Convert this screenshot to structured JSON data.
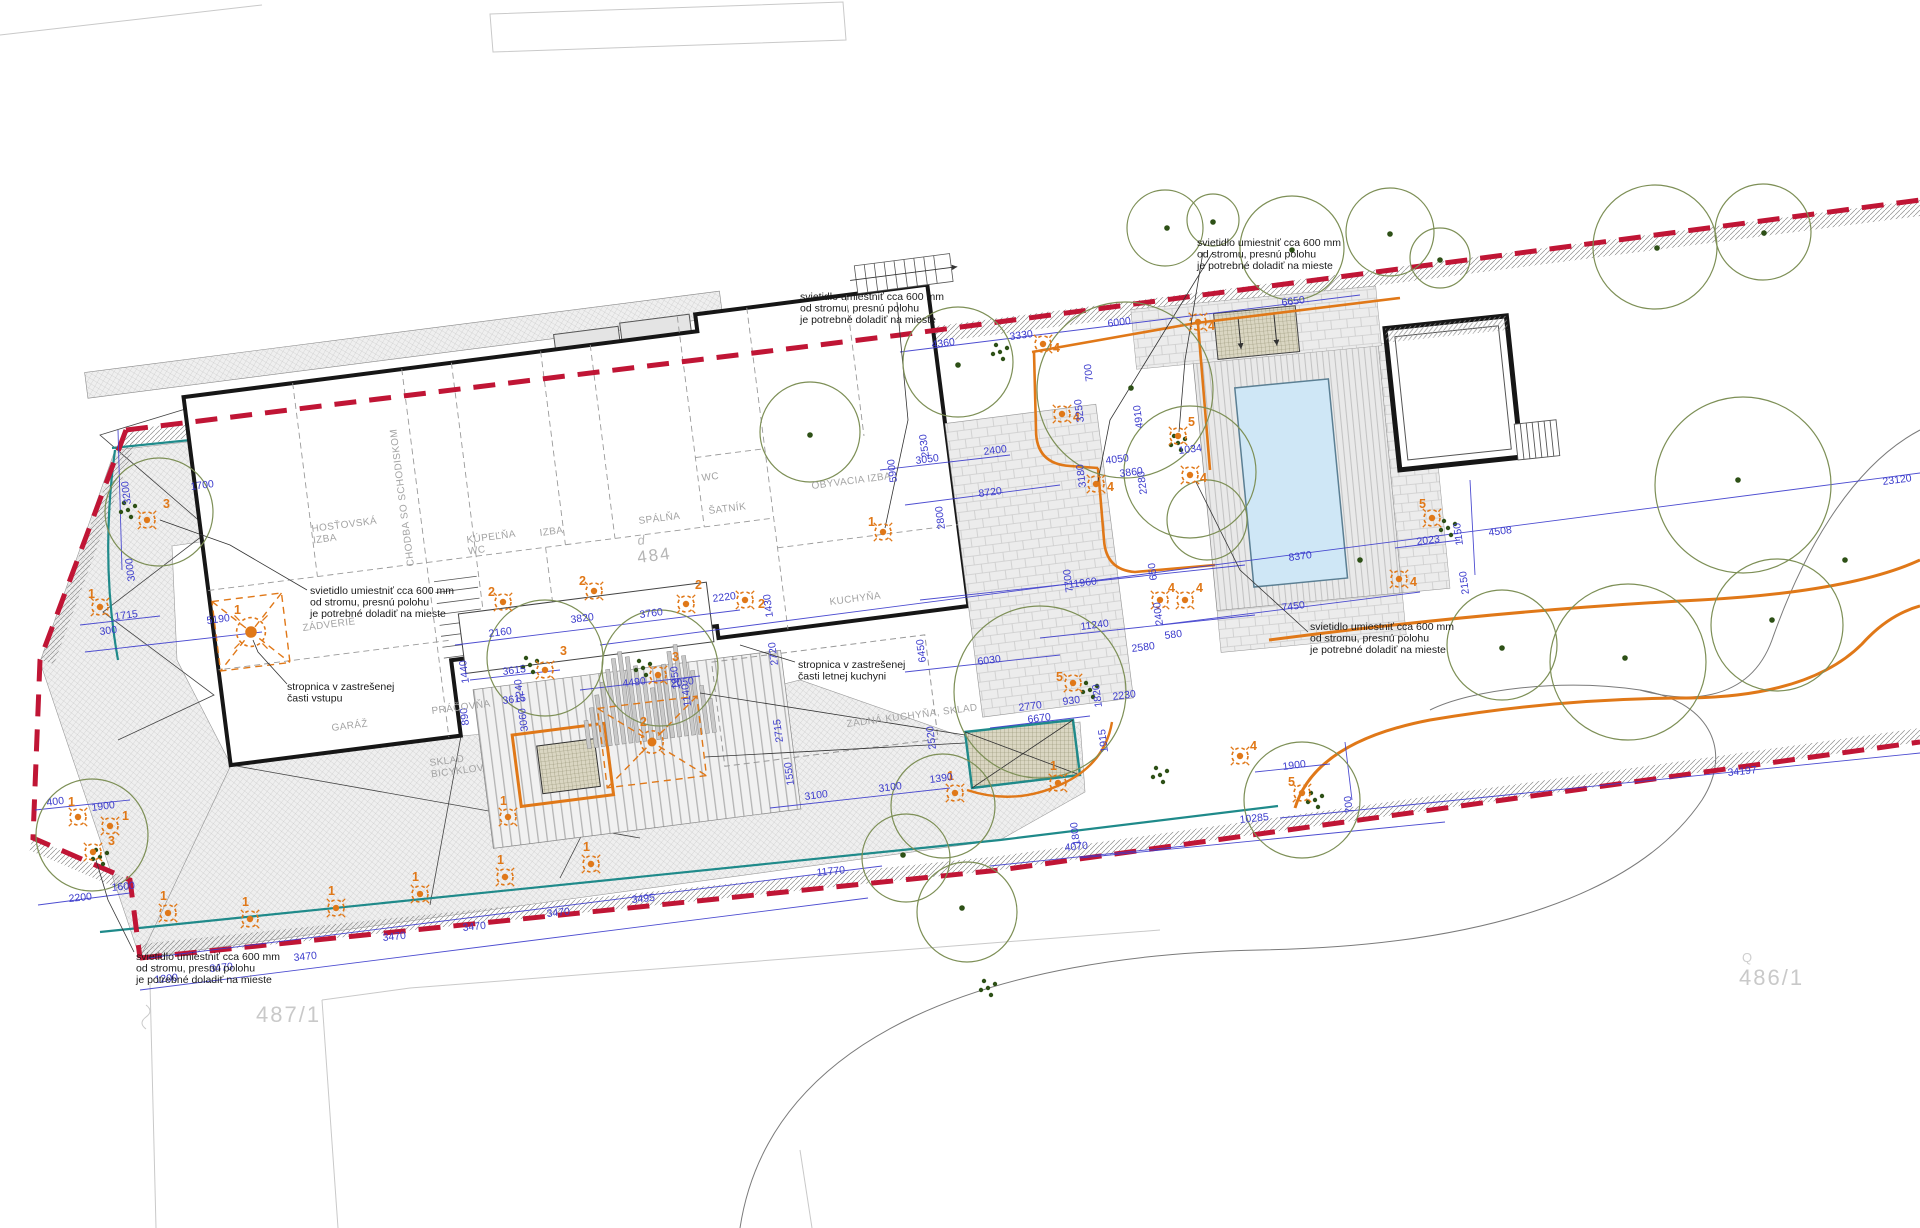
{
  "title": "site plan drawing",
  "colors": {
    "boundary_red": "#c01535",
    "teal": "#1f8a8a",
    "orange": "#e07818",
    "dimension_blue": "#3a3acc",
    "tree_olive": "#7d8f56",
    "tree_dot": "#2d5016",
    "wall_black": "#161616",
    "pool_blue": "#cfe7f6"
  },
  "annotations": {
    "light_note": "svietidlo umiestniť cca 600 mm\nod stromu, presnú polohu\nje potrebné doladiť na mieste",
    "stropnica_entry": "stropnica v zastrešenej\nčasti vstupu",
    "stropnica_kitchen": "stropnica v zastrešenej\nčasti letnej kuchyni"
  },
  "parcels": [
    {
      "label": "487/1",
      "x": 256,
      "y": 1022
    },
    {
      "label": "486/1",
      "x": 1739,
      "y": 985
    },
    {
      "label": "Q",
      "x": 1742,
      "y": 962,
      "small": true
    }
  ],
  "house_number": {
    "prefix": "d",
    "number": "484",
    "x": 638,
    "y": 545
  },
  "rooms": [
    {
      "t": "HOSŤOVSKÁ\nIZBA",
      "x": 312,
      "y": 532,
      "r": "h"
    },
    {
      "t": "CHODBA SO SCHODISKOM",
      "x": 414,
      "y": 566,
      "r": "v"
    },
    {
      "t": "KÚPEĽŇA\nWC",
      "x": 467,
      "y": 543,
      "r": "h"
    },
    {
      "t": "IZBA",
      "x": 540,
      "y": 536,
      "r": "h"
    },
    {
      "t": "SPÁLŇA",
      "x": 639,
      "y": 524,
      "r": "h"
    },
    {
      "t": "WC",
      "x": 702,
      "y": 481,
      "r": "h"
    },
    {
      "t": "ŠATNÍK",
      "x": 709,
      "y": 514,
      "r": "h"
    },
    {
      "t": "OBÝVACIA IZBA",
      "x": 812,
      "y": 489,
      "r": "h"
    },
    {
      "t": "KUCHYŇA",
      "x": 830,
      "y": 605,
      "r": "h"
    },
    {
      "t": "ZÁDVERIE",
      "x": 303,
      "y": 631,
      "r": "h"
    },
    {
      "t": "GARÁŽ",
      "x": 332,
      "y": 731,
      "r": "h"
    },
    {
      "t": "PRÁČOVŇA",
      "x": 432,
      "y": 714,
      "r": "h"
    },
    {
      "t": "SKLAD\nBICYKLOV",
      "x": 430,
      "y": 766,
      "r": "h"
    },
    {
      "t": "ZADNÁ KUCHYŇA, SKLAD",
      "x": 847,
      "y": 727,
      "r": "h"
    }
  ],
  "notes": [
    {
      "t": "svietidlo umiestniť cca 600 mm\nod stromu, presnú polohu\nje potrebné doladiť na mieste",
      "x": 310,
      "y": 594
    },
    {
      "t": "svietidlo umiestniť cca 600 mm\nod stromu, presnú polohu\nje potrebné doladiť na mieste",
      "x": 800,
      "y": 300
    },
    {
      "t": "svietidlo umiestniť cca 600 mm\nod stromu, presnú polohu\nje potrebné doladiť na mieste",
      "x": 1197,
      "y": 246
    },
    {
      "t": "svietidlo umiestniť cca 600 mm\nod stromu, presnú polohu\nje potrebné doladiť na mieste",
      "x": 1310,
      "y": 630
    },
    {
      "t": "svietidlo umiestniť cca 600 mm\nod stromu, presnú polohu\nje potrebné doladiť na mieste",
      "x": 136,
      "y": 960
    },
    {
      "t": "stropnica v zastrešenej\nčasti vstupu",
      "x": 287,
      "y": 690
    },
    {
      "t": "stropnica v zastrešenej\nčasti letnej kuchyni",
      "x": 798,
      "y": 668
    }
  ],
  "dimensions": [
    [
      "1700",
      191,
      482,
      "h"
    ],
    [
      "3200",
      131,
      462,
      "v"
    ],
    [
      "3000",
      135,
      539,
      "v"
    ],
    [
      "5190",
      207,
      616,
      "h"
    ],
    [
      "1715",
      115,
      612,
      "h"
    ],
    [
      "300",
      100,
      627,
      "h"
    ],
    [
      "400",
      47,
      798,
      "h"
    ],
    [
      "1900",
      92,
      803,
      "h"
    ],
    [
      "2200",
      69,
      894,
      "b"
    ],
    [
      "1600",
      112,
      883,
      "b"
    ],
    [
      "1200",
      155,
      975,
      "b"
    ],
    [
      "3470",
      210,
      964,
      "b"
    ],
    [
      "3470",
      294,
      953,
      "b"
    ],
    [
      "3470",
      383,
      933,
      "b"
    ],
    [
      "3470",
      463,
      923,
      "b"
    ],
    [
      "3470",
      547,
      909,
      "b"
    ],
    [
      "3495",
      632,
      895,
      "b"
    ],
    [
      "11770",
      817,
      868,
      "b"
    ],
    [
      "4070",
      1065,
      843,
      "b"
    ],
    [
      "10285",
      1240,
      815,
      "b"
    ],
    [
      "34197",
      1728,
      768,
      "b"
    ],
    [
      "3100",
      805,
      792,
      "h"
    ],
    [
      "3100",
      879,
      784,
      "h"
    ],
    [
      "1390",
      930,
      775,
      "h"
    ],
    [
      "1550",
      794,
      743,
      "v"
    ],
    [
      "2715",
      783,
      700,
      "v"
    ],
    [
      "2520",
      936,
      707,
      "v"
    ],
    [
      "6030",
      978,
      657,
      "h"
    ],
    [
      "6450",
      926,
      620,
      "v"
    ],
    [
      "6670",
      1028,
      715,
      "h"
    ],
    [
      "2770",
      1019,
      703,
      "h"
    ],
    [
      "930",
      1063,
      697,
      "h"
    ],
    [
      "2230",
      1113,
      692,
      "h"
    ],
    [
      "1915",
      1108,
      710,
      "v"
    ],
    [
      "1820",
      1102,
      665,
      "v"
    ],
    [
      "2580",
      1132,
      644,
      "h"
    ],
    [
      "580",
      1165,
      631,
      "h"
    ],
    [
      "11240",
      1081,
      622,
      "h"
    ],
    [
      "11960",
      1069,
      580,
      "h"
    ],
    [
      "7700",
      1073,
      550,
      "v"
    ],
    [
      "1800",
      1080,
      803,
      "v"
    ],
    [
      "3615",
      503,
      667,
      "h"
    ],
    [
      "3615",
      503,
      696,
      "h"
    ],
    [
      "3060",
      528,
      689,
      "v"
    ],
    [
      "890",
      469,
      683,
      "v"
    ],
    [
      "4490",
      623,
      679,
      "h"
    ],
    [
      "2050",
      671,
      679,
      "h"
    ],
    [
      "2240",
      524,
      660,
      "v"
    ],
    [
      "2160",
      489,
      629,
      "h"
    ],
    [
      "3820",
      571,
      615,
      "h"
    ],
    [
      "3760",
      640,
      610,
      "h"
    ],
    [
      "2220",
      713,
      594,
      "h"
    ],
    [
      "1440",
      469,
      641,
      "v"
    ],
    [
      "1950",
      680,
      647,
      "v"
    ],
    [
      "1140",
      691,
      664,
      "v"
    ],
    [
      "1430",
      773,
      575,
      "v"
    ],
    [
      "2720",
      778,
      623,
      "v"
    ],
    [
      "4360",
      932,
      340,
      "h"
    ],
    [
      "3330",
      1010,
      332,
      "h"
    ],
    [
      "6000",
      1108,
      319,
      "h"
    ],
    [
      "6650",
      1282,
      298,
      "h"
    ],
    [
      "700",
      1093,
      339,
      "v"
    ],
    [
      "3250",
      1084,
      380,
      "v"
    ],
    [
      "4910",
      1143,
      386,
      "v"
    ],
    [
      "2530",
      929,
      415,
      "v"
    ],
    [
      "2400",
      984,
      447,
      "h"
    ],
    [
      "3050",
      916,
      456,
      "h"
    ],
    [
      "2800",
      945,
      487,
      "v"
    ],
    [
      "8720",
      979,
      489,
      "h"
    ],
    [
      "5900",
      897,
      440,
      "v"
    ],
    [
      "1034",
      1179,
      446,
      "h"
    ],
    [
      "2280",
      1147,
      452,
      "v"
    ],
    [
      "4050",
      1106,
      456,
      "h"
    ],
    [
      "3860",
      1120,
      469,
      "h"
    ],
    [
      "3180",
      1086,
      445,
      "v"
    ],
    [
      "650",
      1157,
      538,
      "v"
    ],
    [
      "2400",
      1163,
      583,
      "v"
    ],
    [
      "8370",
      1289,
      553,
      "h"
    ],
    [
      "7450",
      1282,
      603,
      "h"
    ],
    [
      "2023",
      1417,
      537,
      "h"
    ],
    [
      "1150",
      1463,
      503,
      "v"
    ],
    [
      "2150",
      1469,
      552,
      "v"
    ],
    [
      "4508",
      1489,
      528,
      "h"
    ],
    [
      "23120",
      1883,
      477,
      "h"
    ],
    [
      "1900",
      1283,
      762,
      "h"
    ],
    [
      "700",
      1353,
      771,
      "v"
    ]
  ],
  "lights": [
    [
      251,
      632,
      "1",
      234,
      614,
      1.8
    ],
    [
      100,
      607,
      "1",
      88,
      598,
      1
    ],
    [
      147,
      520,
      "3",
      163,
      508,
      1
    ],
    [
      545,
      670,
      "3",
      560,
      655,
      1
    ],
    [
      658,
      675,
      "3",
      672,
      661,
      1
    ],
    [
      503,
      602,
      "2",
      488,
      596,
      1
    ],
    [
      594,
      591,
      "2",
      579,
      585,
      1
    ],
    [
      745,
      600,
      "2",
      758,
      608,
      1
    ],
    [
      686,
      604,
      "2",
      695,
      589,
      1
    ],
    [
      883,
      532,
      "1",
      868,
      526,
      1
    ],
    [
      1043,
      344,
      "4",
      1053,
      352,
      1
    ],
    [
      1198,
      322,
      "4",
      1208,
      330,
      1
    ],
    [
      1062,
      414,
      "4",
      1073,
      421,
      1
    ],
    [
      1096,
      484,
      "4",
      1107,
      491,
      1
    ],
    [
      1190,
      475,
      "4",
      1200,
      482,
      1
    ],
    [
      1160,
      600,
      "4",
      1168,
      592,
      1
    ],
    [
      1185,
      600,
      "4",
      1196,
      592,
      1
    ],
    [
      1178,
      436,
      "5",
      1188,
      426,
      1
    ],
    [
      1073,
      683,
      "5",
      1056,
      681,
      1
    ],
    [
      1432,
      518,
      "5",
      1419,
      508,
      1
    ],
    [
      1302,
      793,
      "5",
      1288,
      786,
      1
    ],
    [
      1399,
      579,
      "4",
      1410,
      586,
      1
    ],
    [
      1240,
      756,
      "4",
      1250,
      750,
      1
    ],
    [
      168,
      913,
      "1",
      160,
      900,
      1
    ],
    [
      250,
      919,
      "1",
      242,
      906,
      1
    ],
    [
      336,
      908,
      "1",
      328,
      895,
      1
    ],
    [
      420,
      894,
      "1",
      412,
      881,
      1
    ],
    [
      505,
      877,
      "1",
      497,
      864,
      1
    ],
    [
      591,
      864,
      "1",
      583,
      851,
      1
    ],
    [
      508,
      817,
      "1",
      500,
      805,
      1
    ],
    [
      955,
      793,
      "1",
      947,
      780,
      1
    ],
    [
      1058,
      783,
      "1",
      1050,
      770,
      1
    ],
    [
      78,
      817,
      "1",
      68,
      806,
      1
    ],
    [
      110,
      826,
      "1",
      122,
      820,
      1
    ],
    [
      93,
      852,
      "3",
      108,
      845,
      1
    ],
    [
      652,
      742,
      "2",
      640,
      726,
      1.4
    ]
  ],
  "trees": {
    "circles": [
      [
        159,
        512,
        54
      ],
      [
        545,
        658,
        58
      ],
      [
        660,
        668,
        58
      ],
      [
        810,
        432,
        50
      ],
      [
        958,
        362,
        55
      ],
      [
        1125,
        390,
        88
      ],
      [
        1190,
        472,
        66
      ],
      [
        1040,
        692,
        86
      ],
      [
        943,
        806,
        52
      ],
      [
        967,
        912,
        50
      ],
      [
        906,
        858,
        44
      ],
      [
        92,
        835,
        56
      ],
      [
        1302,
        800,
        58
      ],
      [
        1165,
        228,
        38
      ],
      [
        1213,
        220,
        26
      ],
      [
        1292,
        248,
        52
      ],
      [
        1390,
        232,
        44
      ],
      [
        1440,
        258,
        30
      ],
      [
        1655,
        247,
        62
      ],
      [
        1763,
        232,
        48
      ],
      [
        1743,
        485,
        88
      ],
      [
        1628,
        662,
        78
      ],
      [
        1502,
        645,
        55
      ],
      [
        1777,
        625,
        66
      ],
      [
        1207,
        520,
        40
      ]
    ],
    "dots": [
      [
        1131,
        388
      ],
      [
        1738,
        480
      ],
      [
        1625,
        658
      ],
      [
        1772,
        620
      ],
      [
        962,
        908
      ],
      [
        903,
        855
      ],
      [
        1167,
        228
      ],
      [
        1292,
        250
      ],
      [
        1390,
        234
      ],
      [
        1440,
        260
      ],
      [
        1657,
        248
      ],
      [
        1764,
        233
      ],
      [
        958,
        365
      ],
      [
        810,
        435
      ],
      [
        1502,
        648
      ],
      [
        1213,
        222
      ],
      [
        1360,
        560
      ],
      [
        1845,
        560
      ]
    ],
    "clusters": [
      [
        128,
        510
      ],
      [
        530,
        665
      ],
      [
        643,
        668
      ],
      [
        1178,
        443
      ],
      [
        1090,
        690
      ],
      [
        1448,
        528
      ],
      [
        1160,
        775
      ],
      [
        1315,
        800
      ],
      [
        100,
        857
      ],
      [
        988,
        988
      ],
      [
        1000,
        352
      ]
    ]
  }
}
